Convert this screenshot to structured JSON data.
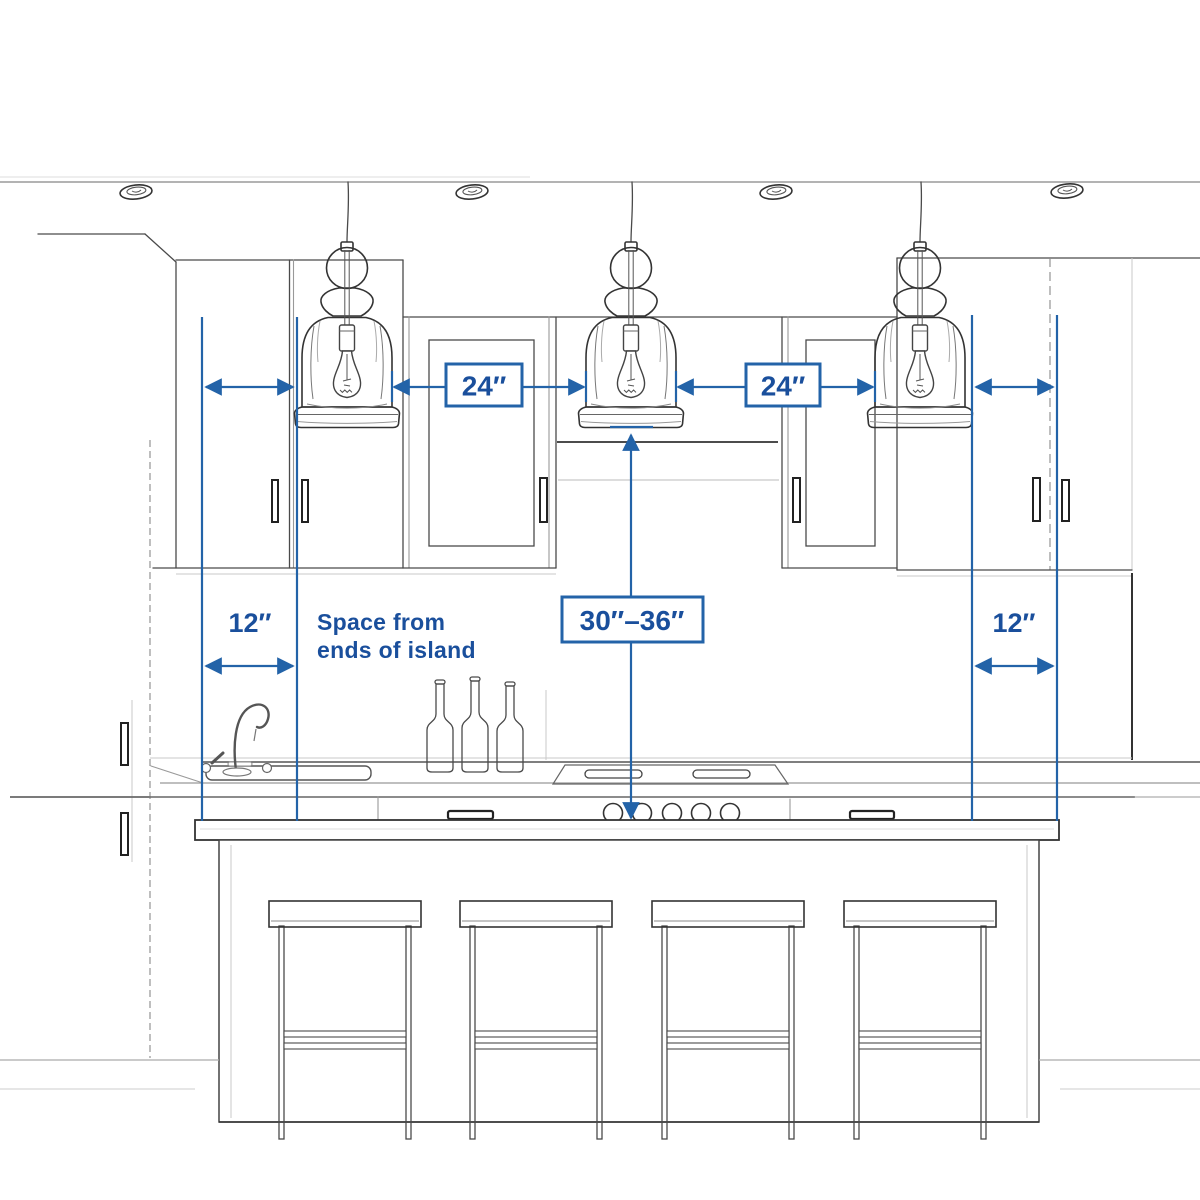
{
  "diagram": {
    "subject": "kitchen-island-pendant-lighting-spacing",
    "annotation_color": "#2363a8",
    "text_color": "#1a4f9c",
    "sketch_color": "#444444",
    "background": "#ffffff",
    "dimensions": {
      "pendant_spacing_left": "24″",
      "pendant_spacing_right": "24″",
      "end_spacing_left": "12″",
      "end_spacing_right": "12″",
      "counter_to_pendant": "30″–36″"
    },
    "note": {
      "line1": "Space from",
      "line2": "ends of island"
    },
    "objects": {
      "pendant_count": 3,
      "recessed_light_count": 4,
      "stool_count": 4,
      "wine_bottle_count": 3,
      "range_knob_count": 5
    }
  }
}
